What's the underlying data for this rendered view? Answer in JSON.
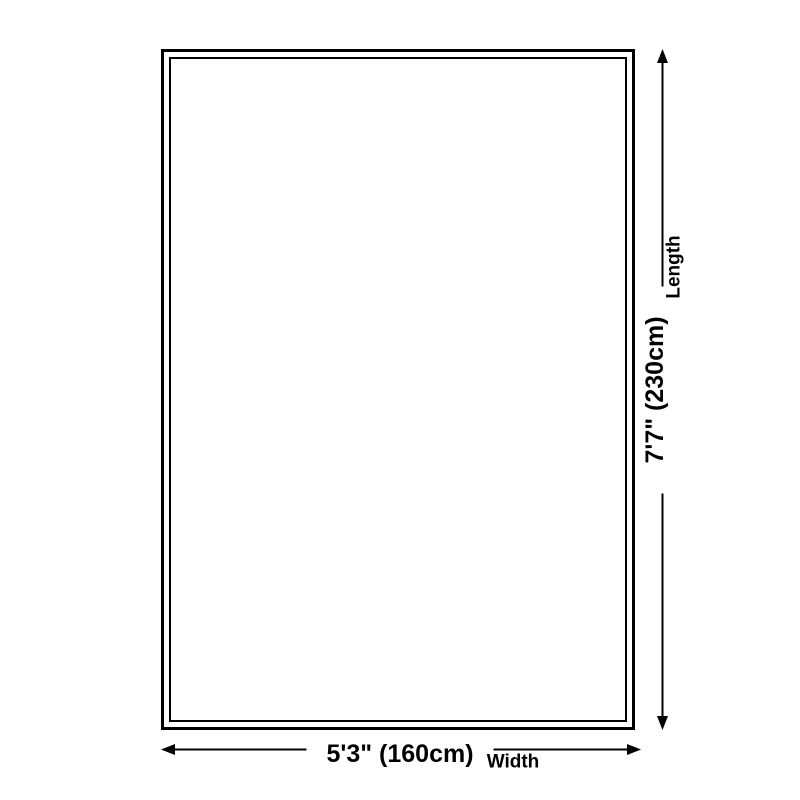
{
  "page": {
    "background_color": "#ffffff",
    "ink_color": "#000000",
    "content_type": "product-size-diagram"
  },
  "diagram": {
    "shape": "rug-rectangle-double-border",
    "width": {
      "value": "5'3\" (160cm)",
      "label": "Width"
    },
    "length": {
      "value": "7'7\" (230cm)",
      "label": "Length"
    }
  }
}
